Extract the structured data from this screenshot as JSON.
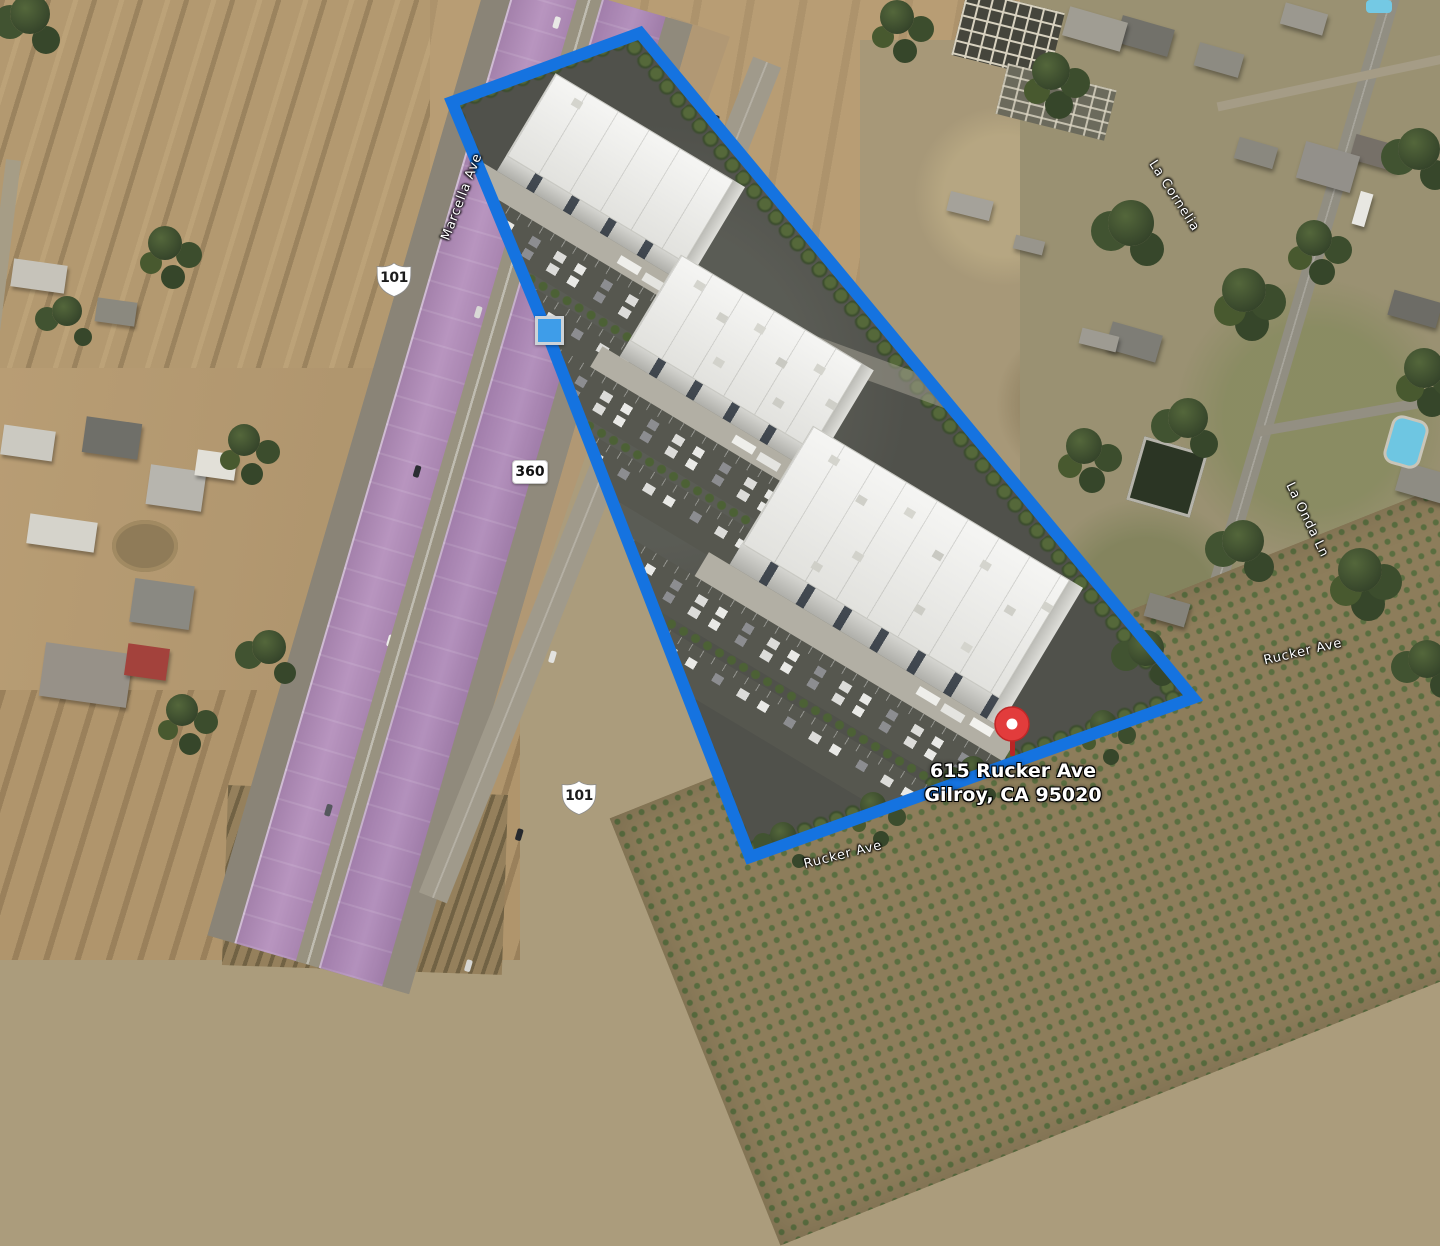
{
  "map_labels": {
    "pin_line1": "615 Rucker Ave",
    "pin_line2": "Gilroy, CA 95020",
    "shield_north": "101",
    "shield_south": "101",
    "exit_marker": "360",
    "road_frontage": "Marcella Ave",
    "road_cornelia": "La Cornelia",
    "road_onda": "La Onda Ln",
    "road_rucker_right": "Rucker Ave",
    "road_rucker_bottom": "Rucker Ave"
  },
  "colors": {
    "boundary_blue": "#1573e0",
    "handle_blue": "#3e9de9",
    "highway_purple": "#b28cba",
    "pin_red": "#e23c3c"
  }
}
